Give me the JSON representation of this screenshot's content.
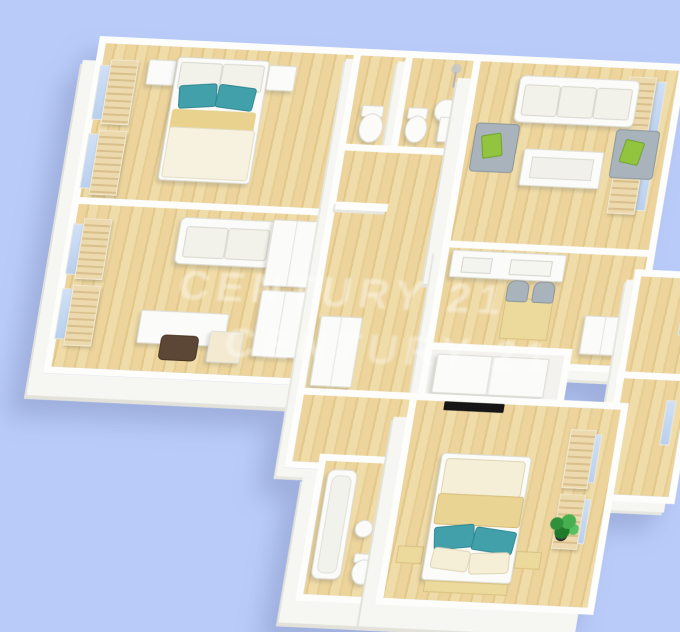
{
  "scene": {
    "description": "3D rendered floor plan of an apartment, tilted axonometric view",
    "background_color": "#b9cbf8",
    "wall_color": "#fdfdfc",
    "wood_floor_light": "#f0dca8",
    "wood_floor_dark": "#e2c78a",
    "accent_teal": "#42a0ab",
    "accent_green": "#92c440",
    "sofa_gray": "#a9b3bb",
    "blind_beige": "#ecd9ae",
    "chair_brown": "#5c4737",
    "plant_green": "#2f8f3a"
  },
  "watermark": {
    "text": "CENTURY 21",
    "opacity": 0.4
  },
  "rooms": [
    {
      "name": "bedroom-top-left",
      "furniture": [
        "double-bed",
        "teal-pillows",
        "nightstand-left",
        "nightstand-right",
        "window-blinds"
      ]
    },
    {
      "name": "study-room",
      "furniture": [
        "loveseat",
        "desk",
        "brown-chair",
        "wardrobe-cabinets",
        "drawer-unit",
        "window-blinds"
      ]
    },
    {
      "name": "wc-room",
      "furniture": [
        "toilet"
      ]
    },
    {
      "name": "bathroom-top",
      "furniture": [
        "toilet",
        "pedestal-sink",
        "shower-fixture"
      ]
    },
    {
      "name": "hallway",
      "furniture": [
        "built-in-closet"
      ]
    },
    {
      "name": "living-room",
      "furniture": [
        "three-seat-sofa",
        "coffee-table",
        "armchair-left",
        "armchair-right",
        "green-pillows",
        "window-blinds"
      ]
    },
    {
      "name": "kitchen-dining",
      "furniture": [
        "kitchen-counter",
        "dining-table",
        "dining-chairs",
        "fridge-cabinet"
      ]
    },
    {
      "name": "storage-room",
      "furniture": [
        "white-wardrobe"
      ]
    },
    {
      "name": "right-wing-room-a",
      "furniture": []
    },
    {
      "name": "right-wing-room-b",
      "furniture": []
    },
    {
      "name": "master-bedroom",
      "furniture": [
        "double-bed",
        "teal-pillows",
        "tan-blanket",
        "foot-bench",
        "wall-tv",
        "potted-plant",
        "window-shutters"
      ]
    },
    {
      "name": "ensuite-bathroom",
      "furniture": [
        "bathtub",
        "toilet",
        "stool"
      ]
    }
  ]
}
